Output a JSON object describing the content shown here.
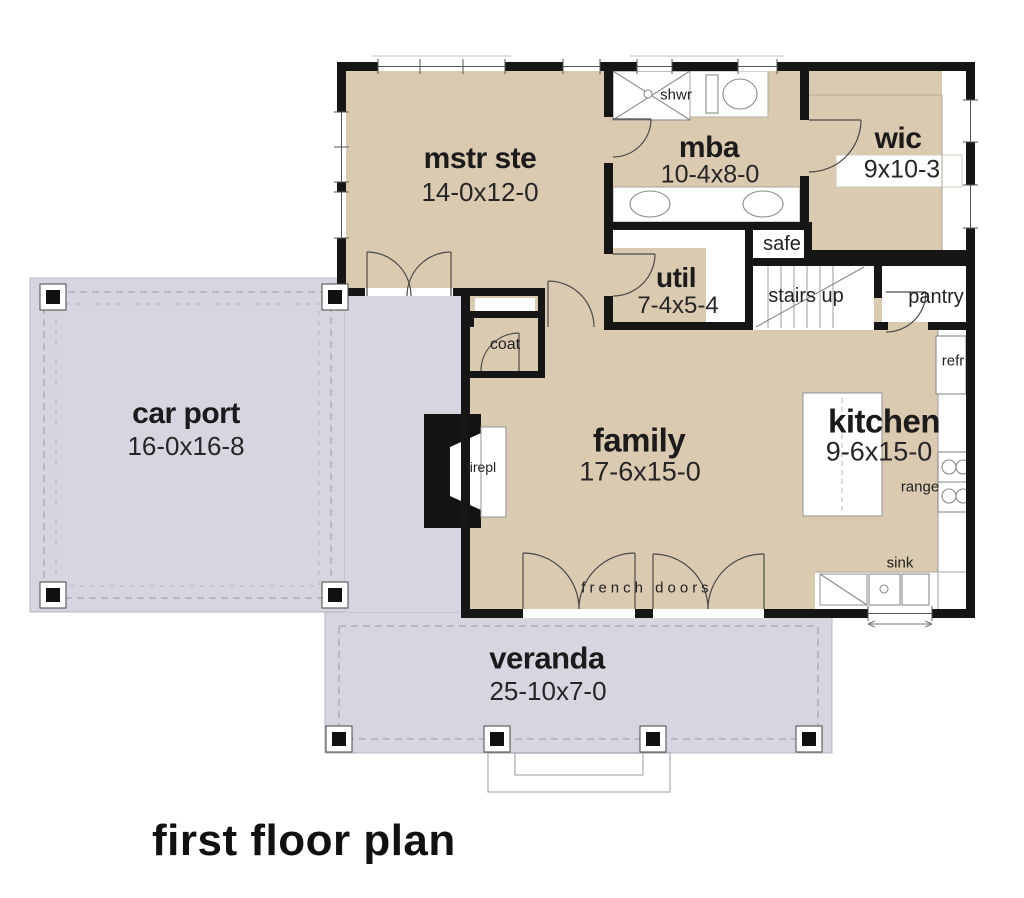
{
  "title": "first floor plan",
  "colors": {
    "interior_fill": "#d9cab0",
    "outdoor_fill": "#d6d6e0",
    "wall": "#161616"
  },
  "rooms": {
    "mstr": {
      "name": "mstr ste",
      "dims": "14-0x12-0"
    },
    "mba": {
      "name": "mba",
      "dims": "10-4x8-0"
    },
    "wic": {
      "name": "wic",
      "dims": "9x10-3"
    },
    "util": {
      "name": "util",
      "dims": "7-4x5-4"
    },
    "family": {
      "name": "family",
      "dims": "17-6x15-0"
    },
    "kitchen": {
      "name": "kitchen",
      "dims": "9-6x15-0"
    },
    "carport": {
      "name": "car port",
      "dims": "16-0x16-8"
    },
    "veranda": {
      "name": "veranda",
      "dims": "25-10x7-0"
    }
  },
  "annotations": {
    "safe": "safe",
    "stairs": "stairs up",
    "pantry": "pantry",
    "coat": "coat",
    "shower": "shwr",
    "fireplace": "firepl",
    "refrigerator": "refr",
    "range": "range",
    "sink": "sink",
    "french_doors": "french doors"
  }
}
